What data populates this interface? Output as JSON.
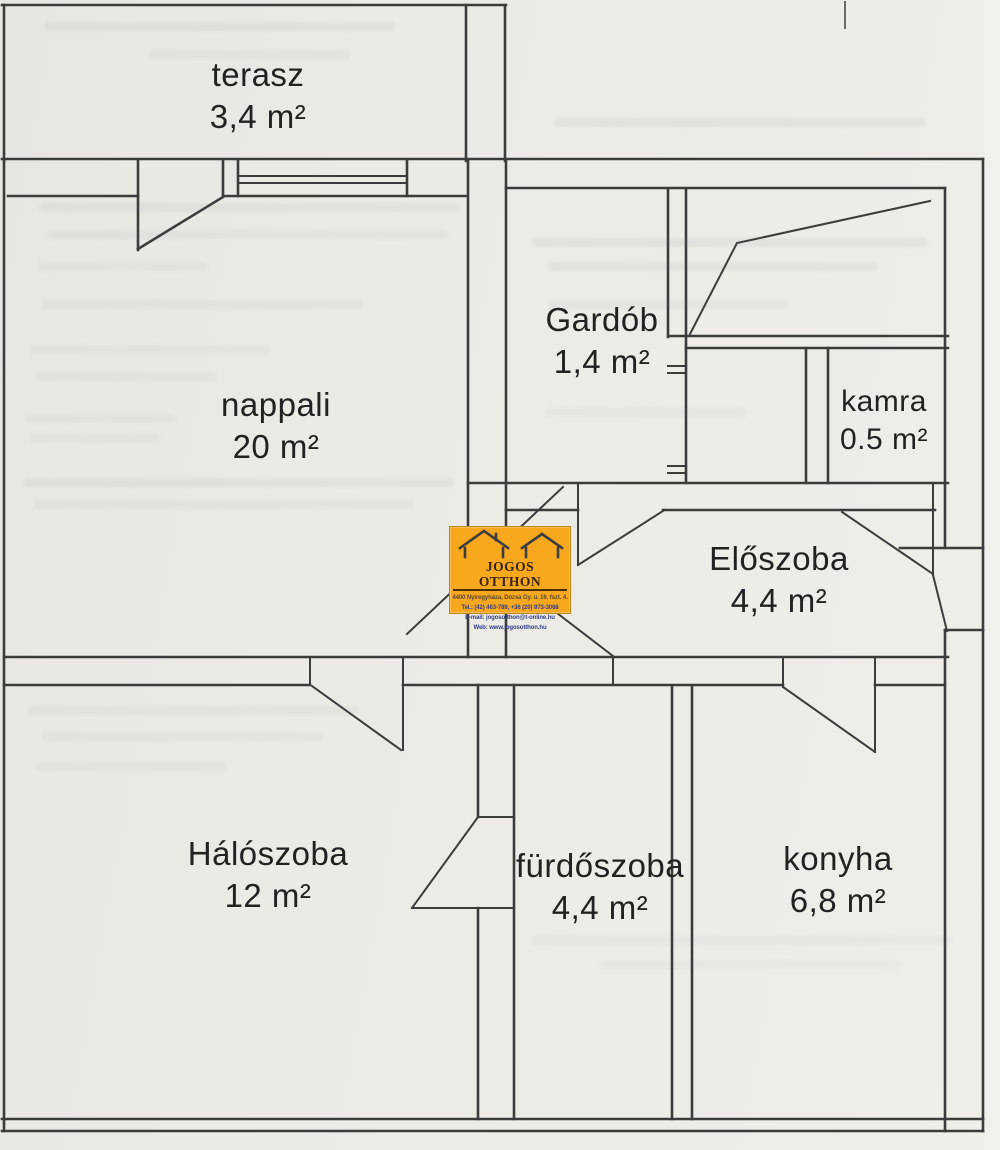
{
  "page": {
    "background": "#eceae5",
    "wall_line_color": "#3c3c3c",
    "label_text_color": "#222222"
  },
  "rooms": [
    {
      "id": "terasz",
      "name": "terasz",
      "area": "3,4 m²"
    },
    {
      "id": "nappali",
      "name": "nappali",
      "area": "20 m²"
    },
    {
      "id": "gardob",
      "name": "Gardób",
      "area": "1,4 m²"
    },
    {
      "id": "kamra",
      "name": "kamra",
      "area": "0.5 m²"
    },
    {
      "id": "eloszoba",
      "name": "Előszoba",
      "area": "4,4 m²"
    },
    {
      "id": "haloszoba",
      "name": "Hálószoba",
      "area": "12 m²"
    },
    {
      "id": "furdoszoba",
      "name": "fürdőszoba",
      "area": "4,4 m²"
    },
    {
      "id": "konyha",
      "name": "konyha",
      "area": "6,8 m²"
    }
  ],
  "logo": {
    "title": "JOGOS OTTHON",
    "address": "4400 Nyíregyháza, Dózsa Gy. u. 16. fszt. 4.",
    "phone": "Tel.: (42) 463-789, +36 (20) 973-3068",
    "email": "E-mail: jogosotthon@t-online.hu",
    "web": "Web: www.jogosotthon.hu",
    "background": "#f7a81d"
  }
}
